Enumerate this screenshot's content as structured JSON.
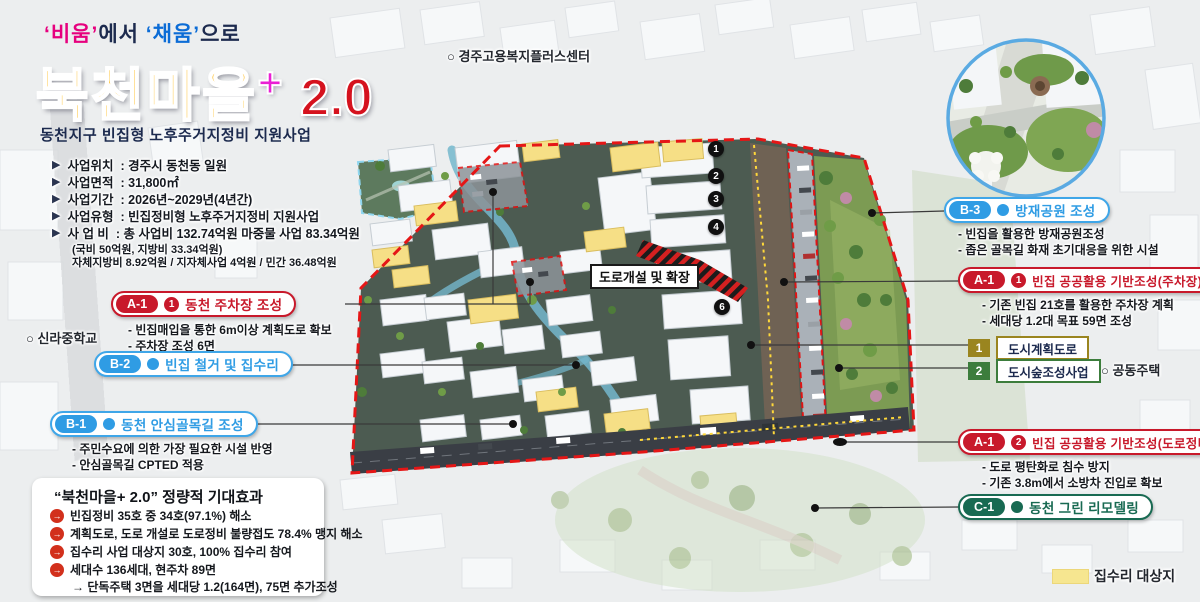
{
  "header": {
    "tagline": {
      "w1": "‘비움’",
      "mid": "에서",
      "w2": "‘채움’",
      "end": "으로"
    },
    "title": "북천마을",
    "plus": "+",
    "version": "2.0",
    "subtitle": "동천지구 빈집형 노후주거지정비 지원사업"
  },
  "project_info": {
    "rows": [
      {
        "label": "사업위치",
        "value": ": 경주시 동천동 일원"
      },
      {
        "label": "사업면적",
        "value": ": 31,800㎡"
      },
      {
        "label": "사업기간",
        "value": ": 2026년~2029년(4년간)"
      },
      {
        "label": "사업유형",
        "value": ": 빈집정비형 노후주거지정비 지원사업"
      },
      {
        "label": "사 업 비",
        "value": ": 총 사업비 132.74억원 마중물 사업 83.34억원"
      }
    ],
    "notes": [
      "(국비 50억원, 지방비 33.34억원)",
      "자체지방비 8.92억원 /  지자체사업 4억원  / 민간 36.48억원"
    ]
  },
  "map": {
    "markers": [
      "1",
      "2",
      "3",
      "4",
      "5",
      "6"
    ],
    "road_label": "도로개설 및 확장",
    "places": {
      "school": "○ 신라중학교",
      "welfare_center": "○ 경주고용복지플러스센터",
      "apartment": "○ 공동주택"
    }
  },
  "callouts": {
    "left": [
      {
        "code": "A-1",
        "num": "1",
        "title": "동천 주차장 조성",
        "bullets": [
          "- 빈집매입을 통한 6m이상 계획도로 확보",
          "- 주차장 조성 6면"
        ]
      },
      {
        "code": "B-2",
        "title": "빈집 철거 및 집수리",
        "bullets": []
      },
      {
        "code": "B-1",
        "title": "동천 안심골목길 조성",
        "bullets": [
          "- 주민수요에 의한 가장 필요한 시설 반영",
          "- 안심골목길 CPTED 적용"
        ]
      }
    ],
    "right": [
      {
        "code": "B-3",
        "title": "방재공원 조성",
        "bullets": [
          "- 빈집을 활용한 방재공원조성",
          "- 좁은 골목길 화재 초기대응을 위한 시설"
        ]
      },
      {
        "code": "A-1",
        "num": "1",
        "title": "빈집 공공활용 기반조성(주차장)",
        "bullets": [
          "- 기존 빈집 21호를 활용한 주차장 계획",
          "- 세대당 1.2대 목표 59면 조성"
        ]
      },
      {
        "code": "A-1",
        "num": "2",
        "title": "빈집 공공활용 기반조성(도로정비)",
        "bullets": [
          "- 도로 평탄화로 침수 방지",
          "- 기존 3.8m에서 소방차 진입로 확보"
        ]
      },
      {
        "code": "C-1",
        "title": "동천 그린 리모델링",
        "bullets": []
      }
    ]
  },
  "legend": {
    "items": [
      {
        "num": "1",
        "label": "도시계획도로"
      },
      {
        "num": "2",
        "label": "도시숲조성사업"
      }
    ],
    "repair_target": "집수리 대상지"
  },
  "effects": {
    "title": "“북천마을+ 2.0” 정량적 기대효과",
    "items": [
      "빈집정비 35호 중 34호(97.1%) 해소",
      "계획도로, 도로 개설로 도로정비 불량접도 78.4% 맹지 해소",
      "집수리 사업 대상지 30호, 100% 집수리 참여",
      "세대수 136세대, 현주차 89면"
    ],
    "item4_sub": "→ 단독주택 3면을 세대당 1.2(164면), 75면 추가조성"
  },
  "colors": {
    "accent_red": "#c8192b",
    "accent_blue": "#2f9ce4",
    "accent_green": "#186a52",
    "accent_olive": "#9a851f",
    "legend_green": "#3c7d3c",
    "title_yellow": "#ffb405",
    "title_magenta": "#ea1fd4",
    "title_red": "#d5121e",
    "navy": "#1c2a4e",
    "boundary_red": "#e51616",
    "repair_yellow": "#f6e690"
  }
}
